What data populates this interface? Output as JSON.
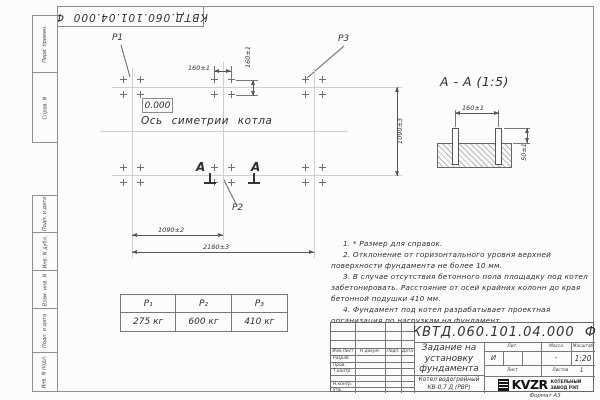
{
  "sheet": {
    "stamp": "КВТД.060.101.04.000  Ф",
    "format": "Формат А3"
  },
  "margin": {
    "labels": [
      "Перв. примен.",
      "Справ. N",
      "Подп. и дата",
      "Инв. N дубл.",
      "Взам. инв. N",
      "Подп. и дата",
      "Инв. N подл."
    ]
  },
  "plan": {
    "labels": {
      "p1": "P1",
      "p2": "P2",
      "p3": "P3",
      "zero": "0.000",
      "axis": "Ось симетрии котла",
      "section": "А"
    },
    "dims": {
      "bolt_h": "160±1",
      "bolt_v": "160±1",
      "row_spacing": "1090±3",
      "half_span": "1090±2",
      "total_span": "2180±3"
    }
  },
  "section_view": {
    "title": "А - А (1:5)",
    "dims": {
      "spacing": "160±1",
      "height": "50±1"
    }
  },
  "notes": [
    "1. * Размер для справок.",
    "2. Отклонение от горизонтального уровня верхней поверхности фундамента не более 10 мм.",
    "3. В случае отсутствия бетонного пола площадку под котел забетонировать. Расстояние от осей крайних колонн до края бетонной подушки 410 мм.",
    "4. Фундамент под котел разрабатывает проектная организация по нагрузкам на фундамент."
  ],
  "load_table": {
    "headers": [
      "P₁",
      "P₂",
      "P₃"
    ],
    "values": [
      "275 кг",
      "600 кг",
      "410 кг"
    ]
  },
  "title_block": {
    "doc_number": "КВТД.060.101.04.000  Ф",
    "title": "Задание на установку фундамента",
    "product": "Котел водогрейный КВ-0,7 Д (РВР)",
    "cols": [
      "Изм.Лист",
      "Н докум.",
      "Подп.",
      "Дата"
    ],
    "rows": [
      "Разраб.",
      "Пров.",
      "Т.контр.",
      "Н.контр.",
      "Утв."
    ],
    "lit_label": "Лит.",
    "mass_label": "Масса",
    "scale_label": "Масштаб",
    "lit": "И",
    "mass": "-",
    "scale": "1:20",
    "sheet_label": "Лист",
    "sheets_label": "Листов",
    "sheets_value": "1",
    "brand": "KVZR",
    "brand_line1": "КОТЕЛЬНЫЙ",
    "brand_line2": "ЗАВОД РЭП"
  }
}
